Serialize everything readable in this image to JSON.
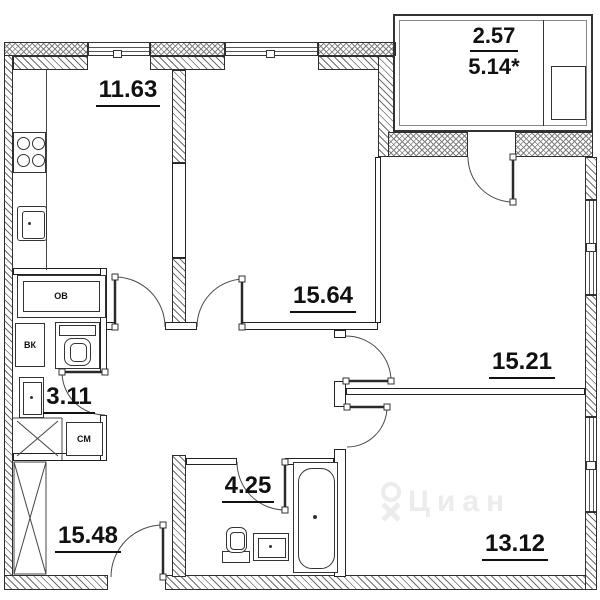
{
  "title": "Apartment floor plan",
  "rooms": [
    {
      "id": "kitchen",
      "area": "11.63"
    },
    {
      "id": "room-middle",
      "area": "15.64"
    },
    {
      "id": "room-right",
      "area": "15.21"
    },
    {
      "id": "bathroom-small",
      "area": "3.11"
    },
    {
      "id": "bathroom-large",
      "area": "4.25"
    },
    {
      "id": "hallway",
      "area": "15.48"
    },
    {
      "id": "room-bottom-right",
      "area": "13.12"
    }
  ],
  "balcony": {
    "area_reduced": "2.57",
    "area_full": "5.14*"
  },
  "equipment_labels": {
    "heating": "ОВ",
    "water_inlet": "ВК",
    "washing_machine": "СМ"
  },
  "watermark": {
    "brand": "Циан"
  },
  "colors": {
    "line": "#222222",
    "hatch": "#6e6e6e",
    "watermark": "#ececec"
  }
}
